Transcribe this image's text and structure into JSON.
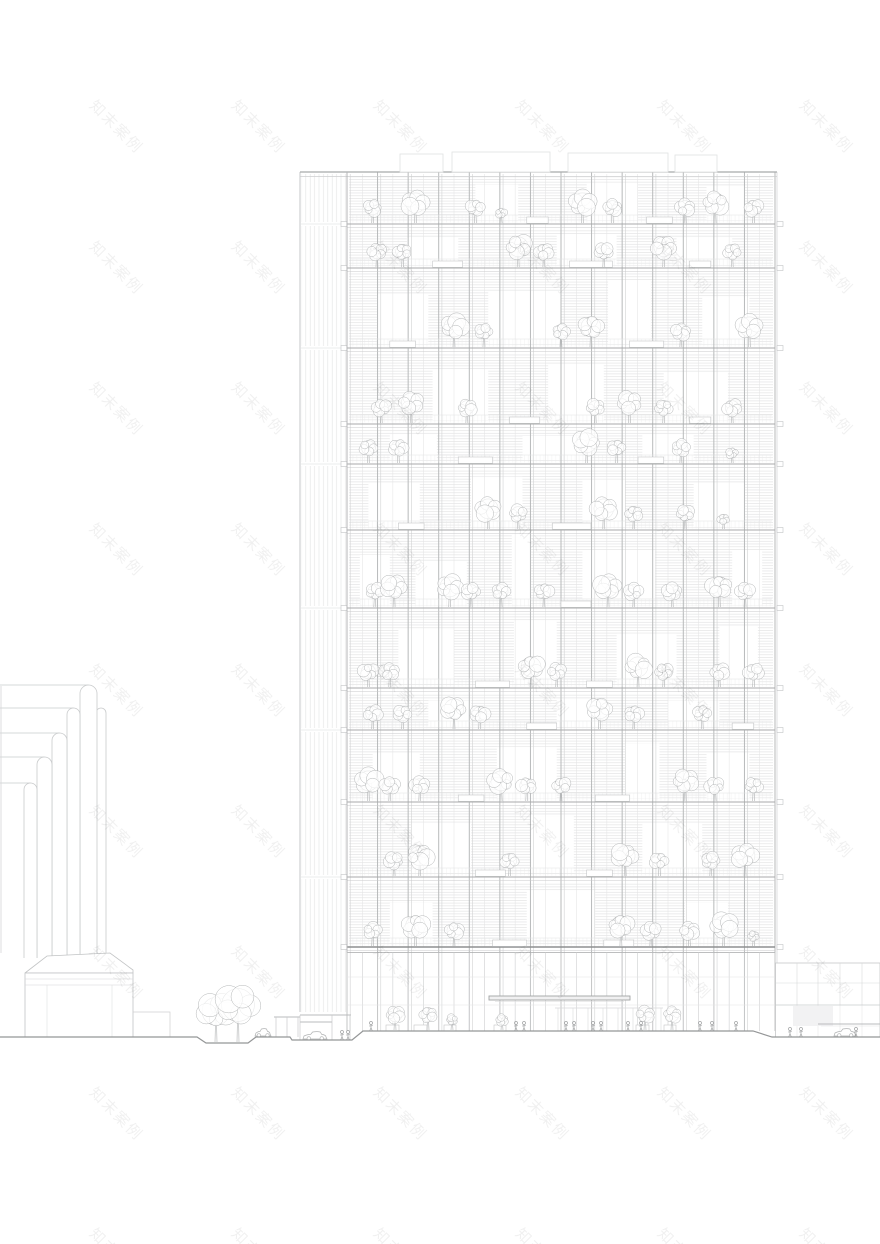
{
  "canvas": {
    "width": 880,
    "height": 1244,
    "background": "#ffffff"
  },
  "watermark": {
    "text": "知末案例",
    "x0": 100,
    "y0": 95,
    "step_x": 142,
    "step_y": 141,
    "rotation_deg": 45
  },
  "palette": {
    "strong": "#8d8f90",
    "slab": "#a8aaab",
    "slab_sub": "#c9cacb",
    "major": "#b4b6b7",
    "major_sub": "#d1d2d3",
    "minor": "#e4e4e5",
    "hatch": "#d9dadb",
    "rail": "#e0e1e2",
    "baluster": "#e9e9ea",
    "outline": "#bfc1c2",
    "light": "#d8d9da",
    "faint": "#e3e4e5",
    "tree": "#b3b5b6",
    "person": "#9fa1a2",
    "car": "#b0b2b3",
    "ground": "#949697",
    "box": "#e0e1e2",
    "panel_fill": "#f2f2f3",
    "canopy": "#a2a4a5",
    "louver": "#e2e3e4"
  },
  "tower": {
    "x0": 347,
    "x1": 775,
    "roof_y": 172,
    "lobby_top": 947,
    "plaza_y": 1031,
    "minor_step": 15.2857,
    "major_step": 30.5714,
    "slabs": [
      172,
      224,
      268,
      348,
      424,
      464,
      530,
      608,
      688,
      730,
      802,
      877,
      947
    ],
    "roof_boxes": [
      [
        400,
        443,
        154
      ],
      [
        452,
        550,
        152
      ],
      [
        568,
        668,
        153
      ],
      [
        675,
        717,
        155
      ]
    ],
    "louver": {
      "x0": 300,
      "x1": 346,
      "top": 174,
      "bottom": 1012,
      "breaks": [
        224,
        348,
        464,
        608,
        730,
        877
      ]
    },
    "edge_ticks": true,
    "floors": [
      {
        "openings": [
          [
            0.3,
            0.4,
            0.2,
            1
          ],
          [
            0.56,
            0.68,
            0.15,
            1
          ],
          [
            0.84,
            0.93,
            0.25,
            1
          ]
        ],
        "trees": [
          [
            0.06,
            2
          ],
          [
            0.16,
            3
          ],
          [
            0.3,
            2
          ],
          [
            0.36,
            1
          ],
          [
            0.55,
            3
          ],
          [
            0.62,
            2
          ],
          [
            0.79,
            2
          ],
          [
            0.86,
            3
          ],
          [
            0.95,
            2
          ]
        ],
        "planters": [
          [
            0.42,
            0.05
          ],
          [
            0.7,
            0.06
          ]
        ]
      },
      {
        "openings": [
          [
            0.14,
            0.26,
            0.25,
            1
          ],
          [
            0.49,
            0.63,
            0.2,
            1
          ],
          [
            0.77,
            0.9,
            0.25,
            1
          ]
        ],
        "trees": [
          [
            0.07,
            2
          ],
          [
            0.13,
            2
          ],
          [
            0.4,
            3
          ],
          [
            0.46,
            2
          ],
          [
            0.6,
            2
          ],
          [
            0.74,
            3
          ],
          [
            0.9,
            2
          ]
        ],
        "planters": [
          [
            0.2,
            0.07
          ],
          [
            0.52,
            0.1
          ],
          [
            0.8,
            0.05
          ]
        ]
      },
      {
        "openings": [
          [
            0.07,
            0.19,
            0.3,
            1
          ],
          [
            0.33,
            0.5,
            0.28,
            1
          ],
          [
            0.61,
            0.71,
            0.12,
            1
          ],
          [
            0.83,
            0.94,
            0.35,
            1
          ]
        ],
        "trees": [
          [
            0.25,
            3
          ],
          [
            0.32,
            2
          ],
          [
            0.5,
            2
          ],
          [
            0.57,
            3
          ],
          [
            0.78,
            2
          ],
          [
            0.94,
            3
          ]
        ],
        "planters": [
          [
            0.1,
            0.06
          ],
          [
            0.66,
            0.08
          ]
        ]
      },
      {
        "openings": [
          [
            0.2,
            0.33,
            0.25,
            1
          ],
          [
            0.47,
            0.6,
            0.18,
            1
          ],
          [
            0.74,
            0.89,
            0.3,
            1
          ]
        ],
        "trees": [
          [
            0.08,
            2
          ],
          [
            0.15,
            3
          ],
          [
            0.28,
            2
          ],
          [
            0.58,
            2
          ],
          [
            0.66,
            3
          ],
          [
            0.74,
            2
          ],
          [
            0.9,
            2
          ]
        ],
        "planters": [
          [
            0.38,
            0.07
          ],
          [
            0.8,
            0.05
          ]
        ]
      },
      {
        "openings": [
          [
            0.1,
            0.21,
            0.2,
            1
          ],
          [
            0.41,
            0.57,
            0.25,
            1
          ],
          [
            0.69,
            0.81,
            0.2,
            1
          ]
        ],
        "trees": [
          [
            0.05,
            2
          ],
          [
            0.12,
            2
          ],
          [
            0.56,
            3
          ],
          [
            0.63,
            2
          ],
          [
            0.78,
            2
          ],
          [
            0.9,
            1
          ]
        ],
        "planters": [
          [
            0.26,
            0.08
          ],
          [
            0.68,
            0.06
          ]
        ]
      },
      {
        "openings": [
          [
            0.05,
            0.17,
            0.25,
            1
          ],
          [
            0.29,
            0.41,
            0.15,
            1
          ],
          [
            0.55,
            0.65,
            0.2,
            1
          ],
          [
            0.81,
            0.93,
            0.25,
            1
          ]
        ],
        "trees": [
          [
            0.33,
            3
          ],
          [
            0.4,
            2
          ],
          [
            0.6,
            3
          ],
          [
            0.67,
            2
          ],
          [
            0.79,
            2
          ],
          [
            0.88,
            1
          ]
        ],
        "planters": [
          [
            0.12,
            0.06
          ],
          [
            0.48,
            0.09
          ]
        ]
      },
      {
        "openings": [
          [
            0.03,
            0.1,
            0.3,
            1
          ],
          [
            0.16,
            0.28,
            0.4,
            1
          ],
          [
            0.385,
            0.43,
            0.02,
            1
          ],
          [
            0.55,
            0.72,
            0.25,
            0.92
          ],
          [
            0.9,
            0.97,
            0.25,
            1
          ]
        ],
        "trees": [
          [
            0.065,
            2
          ],
          [
            0.11,
            3
          ],
          [
            0.24,
            3
          ],
          [
            0.29,
            2
          ],
          [
            0.36,
            2
          ],
          [
            0.46,
            2
          ],
          [
            0.61,
            3
          ],
          [
            0.67,
            2
          ],
          [
            0.76,
            2
          ],
          [
            0.87,
            3
          ],
          [
            0.93,
            2
          ]
        ],
        "planters": [
          [
            0.5,
            0.07
          ]
        ]
      },
      {
        "openings": [
          [
            0.12,
            0.25,
            0.25,
            1
          ],
          [
            0.39,
            0.49,
            0.12,
            1
          ],
          [
            0.63,
            0.77,
            0.3,
            1
          ],
          [
            0.87,
            0.96,
            0.2,
            1
          ]
        ],
        "trees": [
          [
            0.05,
            2
          ],
          [
            0.1,
            2
          ],
          [
            0.43,
            3
          ],
          [
            0.49,
            2
          ],
          [
            0.68,
            3
          ],
          [
            0.74,
            2
          ],
          [
            0.87,
            2
          ],
          [
            0.95,
            2
          ]
        ],
        "planters": [
          [
            0.3,
            0.08
          ],
          [
            0.56,
            0.06
          ]
        ]
      },
      {
        "openings": [
          [
            0.19,
            0.29,
            0.25,
            1
          ],
          [
            0.49,
            0.59,
            0.2,
            1
          ],
          [
            0.75,
            0.87,
            0.25,
            1
          ]
        ],
        "trees": [
          [
            0.06,
            2
          ],
          [
            0.13,
            2
          ],
          [
            0.25,
            3
          ],
          [
            0.31,
            2
          ],
          [
            0.59,
            3
          ],
          [
            0.67,
            2
          ],
          [
            0.83,
            2
          ]
        ],
        "planters": [
          [
            0.42,
            0.07
          ],
          [
            0.9,
            0.05
          ]
        ]
      },
      {
        "openings": [
          [
            0.06,
            0.17,
            0.3,
            1
          ],
          [
            0.35,
            0.49,
            0.2,
            1
          ],
          [
            0.65,
            0.73,
            0.15,
            1
          ],
          [
            0.84,
            0.94,
            0.3,
            1
          ]
        ],
        "trees": [
          [
            0.05,
            3
          ],
          [
            0.1,
            2
          ],
          [
            0.17,
            2
          ],
          [
            0.36,
            3
          ],
          [
            0.42,
            2
          ],
          [
            0.5,
            2
          ],
          [
            0.79,
            3
          ],
          [
            0.86,
            2
          ],
          [
            0.95,
            2
          ]
        ],
        "planters": [
          [
            0.26,
            0.06
          ],
          [
            0.58,
            0.08
          ]
        ]
      },
      {
        "openings": [
          [
            0.15,
            0.29,
            0.25,
            1
          ],
          [
            0.43,
            0.53,
            0.15,
            1
          ],
          [
            0.69,
            0.83,
            0.25,
            1
          ]
        ],
        "trees": [
          [
            0.11,
            2
          ],
          [
            0.17,
            3
          ],
          [
            0.38,
            2
          ],
          [
            0.65,
            3
          ],
          [
            0.73,
            2
          ],
          [
            0.85,
            2
          ],
          [
            0.93,
            3
          ]
        ],
        "planters": [
          [
            0.3,
            0.07
          ],
          [
            0.56,
            0.06
          ]
        ]
      },
      {
        "openings": [
          [
            0.1,
            0.2,
            0.35,
            1
          ],
          [
            0.42,
            0.58,
            0.15,
            0.96
          ],
          [
            0.79,
            0.89,
            0.35,
            1
          ]
        ],
        "trees": [
          [
            0.06,
            2
          ],
          [
            0.16,
            3
          ],
          [
            0.25,
            2
          ],
          [
            0.64,
            3
          ],
          [
            0.71,
            2
          ],
          [
            0.8,
            2
          ],
          [
            0.88,
            3
          ],
          [
            0.95,
            1
          ]
        ],
        "planters": [
          [
            0.34,
            0.08
          ],
          [
            0.6,
            0.07
          ]
        ]
      }
    ]
  },
  "lobby": {
    "transoms": [
      977,
      1005
    ],
    "canopy": {
      "x0": 489,
      "x1": 630,
      "y": 996,
      "h": 4
    },
    "door": {
      "x0": 555,
      "x1": 663,
      "header_y": 1008,
      "mullions": [
        558,
        573,
        588,
        603,
        618,
        633,
        648,
        661
      ]
    },
    "interior_trees": [
      [
        395,
        2
      ],
      [
        428,
        2
      ],
      [
        452,
        1
      ],
      [
        502,
        1
      ],
      [
        645,
        2
      ],
      [
        672,
        2
      ]
    ],
    "ground_planters": [
      [
        386,
        13
      ],
      [
        414,
        13
      ],
      [
        444,
        12
      ],
      [
        494,
        12
      ],
      [
        636,
        13
      ],
      [
        664,
        12
      ]
    ]
  },
  "monument": {
    "pipes": [
      {
        "x0": 96,
        "x1": 106,
        "top": 708,
        "hline": false
      },
      {
        "x0": 80,
        "x1": 97,
        "top": 685,
        "hline": true
      },
      {
        "x0": 67,
        "x1": 80,
        "top": 708,
        "hline": true
      },
      {
        "x0": 52,
        "x1": 67,
        "top": 733,
        "hline": true
      },
      {
        "x0": 37,
        "x1": 52,
        "top": 757,
        "hline": true
      },
      {
        "x0": 24,
        "x1": 37,
        "top": 783,
        "hline": true
      }
    ],
    "edge_line": {
      "x": 1,
      "y0": 686,
      "y1": 953
    },
    "pedestal": {
      "cap": [
        [
          25,
          973
        ],
        [
          47,
          956
        ],
        [
          110,
          953
        ],
        [
          133,
          970
        ],
        [
          133,
          973
        ],
        [
          25,
          973
        ]
      ],
      "box": [
        25,
        973,
        108,
        64
      ],
      "hlines": [
        979,
        985
      ],
      "vlines": [
        47,
        112
      ],
      "step": {
        "x0": 133,
        "x1": 170,
        "y": 1012
      }
    }
  },
  "annex": {
    "x0": 775.5,
    "x1": 880,
    "top": 963,
    "bottom": 1037,
    "verticals": [
      797,
      818,
      840,
      862
    ],
    "h_upper": 983,
    "h_mid": 1005,
    "panel": [
      793,
      1006,
      40,
      20
    ],
    "canopy": {
      "x0": 818,
      "x1": 880,
      "y": 1024
    }
  },
  "site": {
    "ground_path": [
      [
        0,
        1037
      ],
      [
        197,
        1037
      ],
      [
        206,
        1043
      ],
      [
        248,
        1043
      ],
      [
        256,
        1037
      ],
      [
        290,
        1037
      ],
      [
        292,
        1040
      ],
      [
        352,
        1040
      ],
      [
        363,
        1031
      ],
      [
        753,
        1031
      ],
      [
        772,
        1037
      ],
      [
        880,
        1037
      ]
    ],
    "ground_trees": [
      [
        216,
        1042,
        5
      ],
      [
        238,
        1042,
        6
      ]
    ],
    "mini_canopy": {
      "x0": 274,
      "x1": 300,
      "y": 1017,
      "posts": [
        276,
        287,
        298
      ],
      "post_bottom": 1037
    },
    "drop_canopy": {
      "lines": [
        [
          300,
          351,
          1015
        ],
        [
          300,
          332,
          1022
        ]
      ],
      "posts": [
        300,
        332,
        350
      ],
      "post_bottom": 1040
    },
    "cars": [
      [
        255,
        1036,
        16
      ],
      [
        303,
        1039,
        24
      ],
      [
        834,
        1036,
        22
      ]
    ],
    "people": [
      [
        371,
        1031
      ],
      [
        516,
        1031
      ],
      [
        524,
        1031
      ],
      [
        566,
        1031
      ],
      [
        574,
        1031
      ],
      [
        593,
        1031
      ],
      [
        601,
        1031
      ],
      [
        628,
        1031
      ],
      [
        641,
        1031
      ],
      [
        700,
        1031
      ],
      [
        712,
        1031
      ],
      [
        736,
        1031
      ],
      [
        342,
        1040
      ],
      [
        348,
        1040
      ],
      [
        790,
        1037
      ],
      [
        801,
        1037
      ],
      [
        856,
        1037
      ]
    ]
  }
}
